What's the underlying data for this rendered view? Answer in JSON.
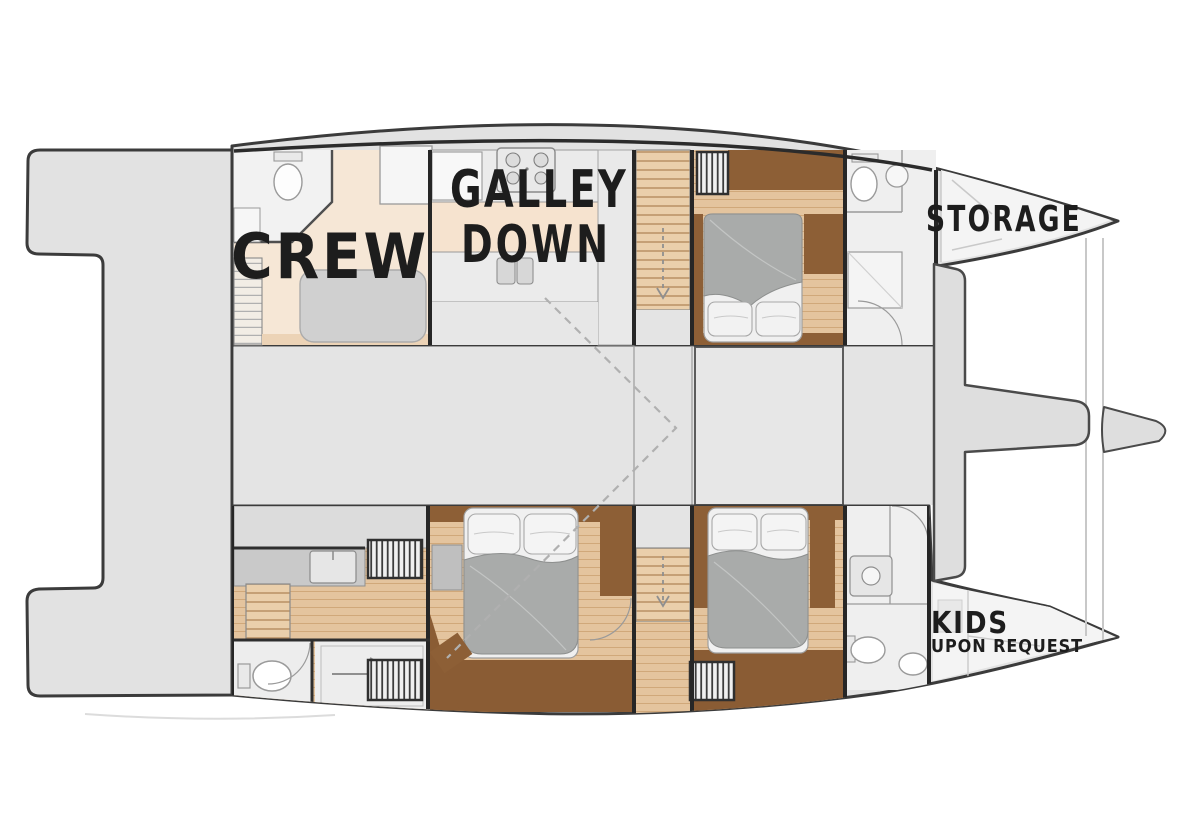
{
  "labels": {
    "crew": "CREW",
    "galley_line1": "GALLEY",
    "galley_line2": "DOWN",
    "storage": "STORAGE",
    "kids": "KIDS",
    "kids_subtitle": "UPON REQUEST"
  },
  "palette": {
    "background": "#ffffff",
    "hull_fill": "#e2e2e2",
    "bow_fill": "#f4f4f4",
    "saloon_fill": "#e4e4e4",
    "outline": "#3b3b3b",
    "wall": "#262626",
    "floor_cream": "#f6e7d6",
    "wood_light": "#e4c49e",
    "wood_plank_line": "#d0a87a",
    "wood_dark": "#8d5f36",
    "wood_darker": "#7c5028",
    "duvet_gray": "#a9abaa",
    "linen_white": "#f0f0f0",
    "fixture_fill": "#ededed",
    "counter_gray": "#d9d9d9",
    "label_ink": "#1d1d1d",
    "dash_gray": "#b0b0b0"
  },
  "icons": {
    "stove": "stove-burners-grid",
    "sink": "double-sink",
    "toilet": "toilet-oval",
    "shower": "shower-arrow",
    "bed": "double-bed",
    "wardrobe": "hanging-locker-stripes",
    "stairs": "companionway-steps"
  }
}
